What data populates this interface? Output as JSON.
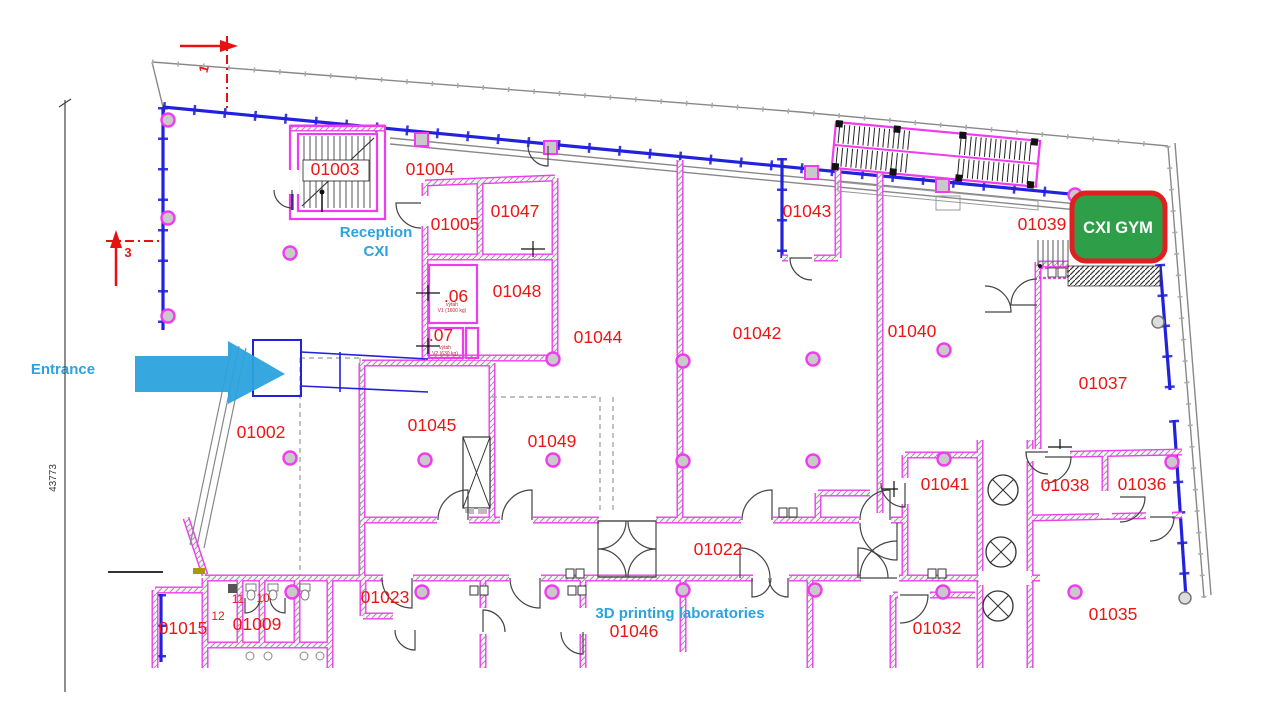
{
  "plan": {
    "annotations": {
      "entrance": "Entrance",
      "reception_line1": "Reception",
      "reception_line2": "CXI",
      "printing_lab": "3D printing laboratories",
      "gym": "CXI GYM"
    },
    "dimension_left": "43773",
    "section_markers": {
      "marker1": "1",
      "marker3": "3"
    },
    "room_labels": [
      {
        "text": "01003",
        "x": 335,
        "y": 175
      },
      {
        "text": "01004",
        "x": 430,
        "y": 175
      },
      {
        "text": "01005",
        "x": 455,
        "y": 230
      },
      {
        "text": "01047",
        "x": 515,
        "y": 217
      },
      {
        "text": "01048",
        "x": 517,
        "y": 297
      },
      {
        "text": ".06",
        "x": 456,
        "y": 302
      },
      {
        "text": ".07",
        "x": 441,
        "y": 341
      },
      {
        "text": "01044",
        "x": 598,
        "y": 343
      },
      {
        "text": "01042",
        "x": 757,
        "y": 339
      },
      {
        "text": "01040",
        "x": 912,
        "y": 337
      },
      {
        "text": "01043",
        "x": 807,
        "y": 217
      },
      {
        "text": "01039",
        "x": 1042,
        "y": 230
      },
      {
        "text": "01037",
        "x": 1103,
        "y": 389
      },
      {
        "text": "01002",
        "x": 261,
        "y": 438
      },
      {
        "text": "01045",
        "x": 432,
        "y": 431
      },
      {
        "text": "01049",
        "x": 552,
        "y": 447
      },
      {
        "text": "01041",
        "x": 945,
        "y": 490
      },
      {
        "text": "01038",
        "x": 1065,
        "y": 491
      },
      {
        "text": "01036",
        "x": 1142,
        "y": 490
      },
      {
        "text": "01022",
        "x": 718,
        "y": 555
      },
      {
        "text": "01023",
        "x": 385,
        "y": 603
      },
      {
        "text": "01046",
        "x": 634,
        "y": 637
      },
      {
        "text": "01015",
        "x": 183,
        "y": 634
      },
      {
        "text": "01009",
        "x": 257,
        "y": 630
      },
      {
        "text": "01032",
        "x": 937,
        "y": 634
      },
      {
        "text": "01035",
        "x": 1113,
        "y": 620
      }
    ],
    "small_labels": [
      {
        "text": "12",
        "x": 218,
        "y": 620
      },
      {
        "text": "11",
        "x": 238,
        "y": 603
      },
      {
        "text": "10",
        "x": 263,
        "y": 602
      }
    ],
    "tiny_labels": [
      {
        "text": "výtah",
        "x": 452,
        "y": 306
      },
      {
        "text": "V1 (1600 kg)",
        "x": 452,
        "y": 312
      },
      {
        "text": "výtah",
        "x": 445,
        "y": 349
      },
      {
        "text": "V2 (630 kg)",
        "x": 445,
        "y": 355
      }
    ],
    "colors": {
      "wall_magenta": "#ef3cef",
      "glazing_blue": "#2222dd",
      "label_red": "#ee1515",
      "annotation_cyan": "#2ba3dd",
      "gym_green": "#2f9e49",
      "gym_border_red": "#e02020"
    }
  }
}
